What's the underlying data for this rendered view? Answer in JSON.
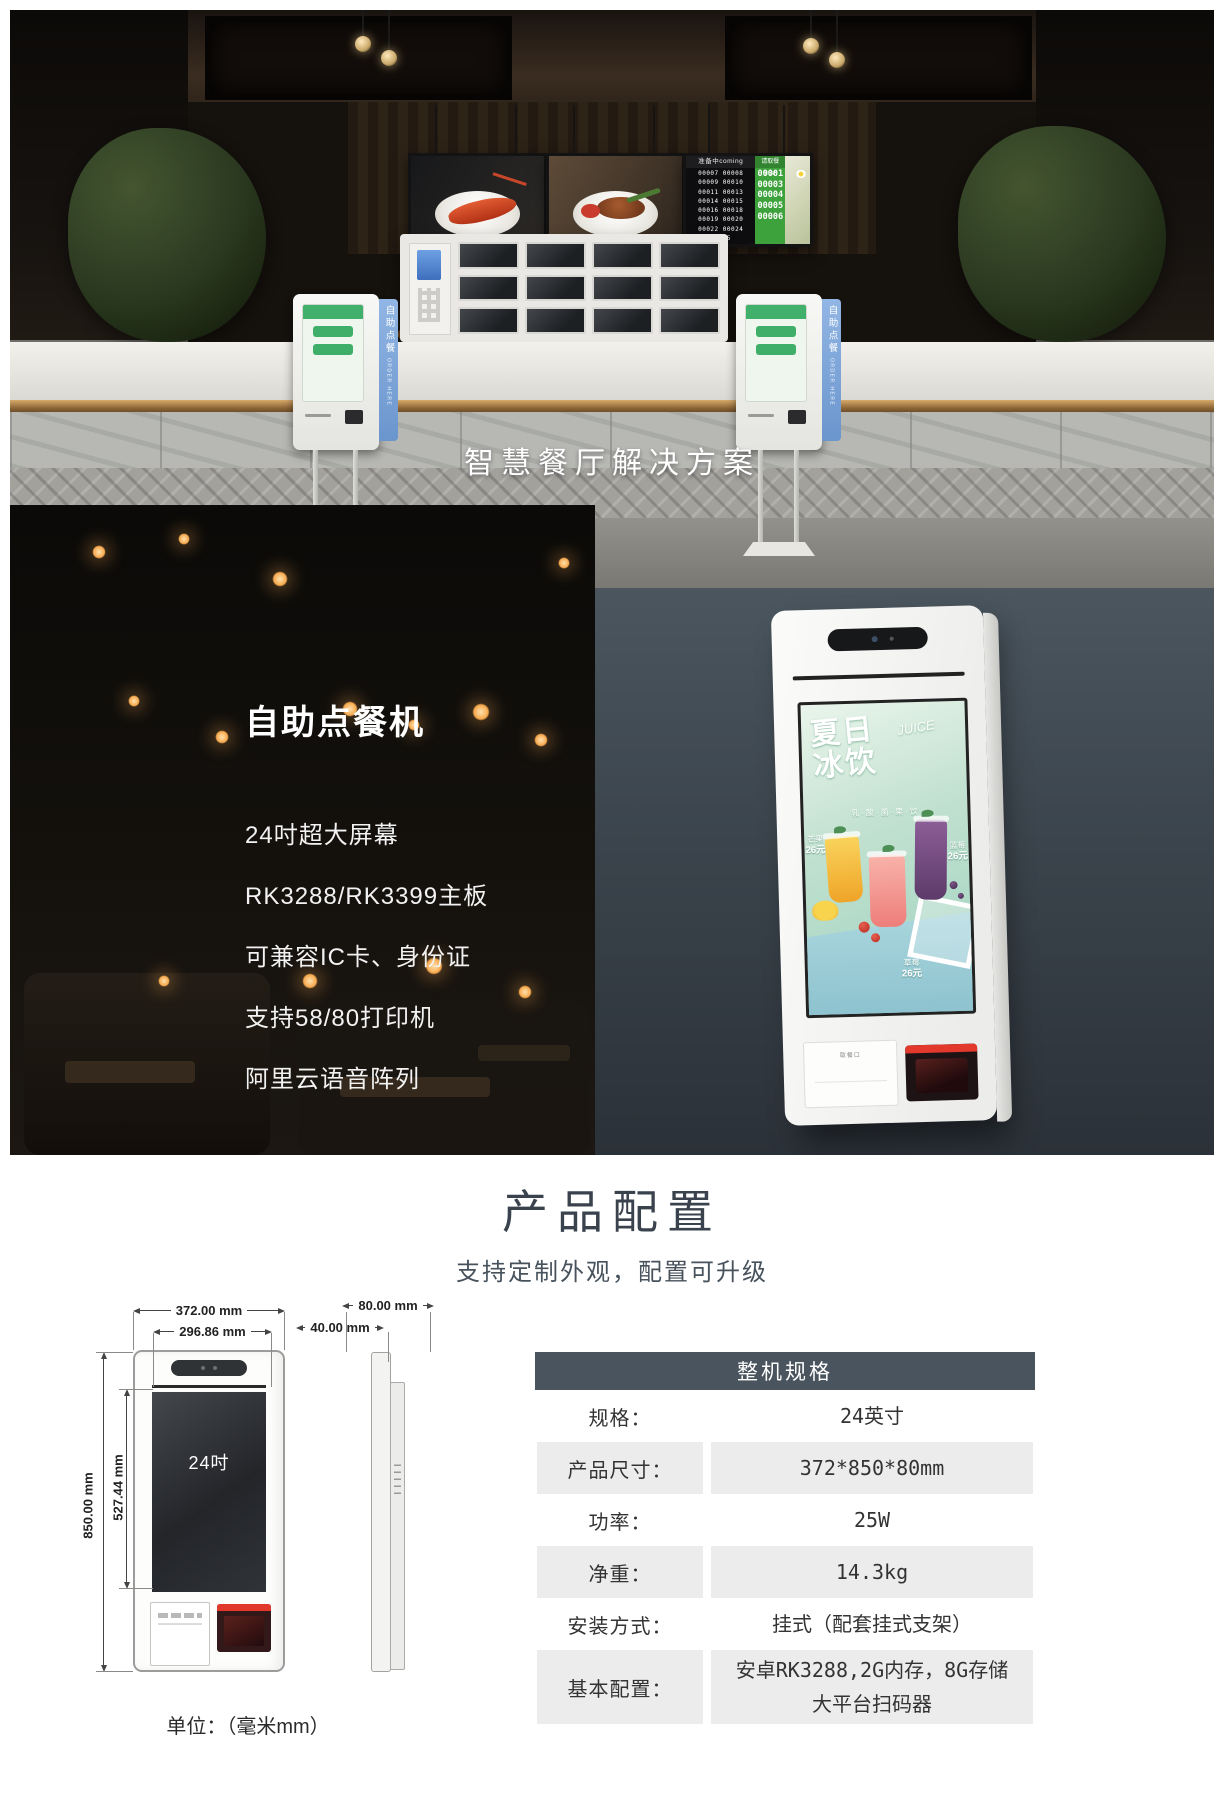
{
  "hero": {
    "title": "智慧餐厅解决方案",
    "kiosk_banner_cn": "自助点餐",
    "kiosk_banner_en": "ORDER HERE",
    "queue_board": {
      "coming_header": "准备中coming",
      "finish_header": "请取餐finish",
      "coming_lines": [
        "00007  00008",
        "00009  00010",
        "00011  00013",
        "00014  00015",
        "00016  00018",
        "00019  00020",
        "00022  00024",
        "00025"
      ],
      "finish_numbers": [
        "00001",
        "00003",
        "00004",
        "00005",
        "00006"
      ]
    }
  },
  "product": {
    "title": "自助点餐机",
    "features": [
      "24吋超大屏幕",
      "RK3288/RK3399主板",
      "可兼容IC卡、身份证",
      "支持58/80打印机",
      "阿里云语音阵列"
    ],
    "poster": {
      "title_line1": "夏日",
      "title_line2": "冰饮",
      "script": "JUICE",
      "subtitle": "乳·酸·菌·果·饮",
      "items": [
        {
          "name": "芒果",
          "price": "26元"
        },
        {
          "name": "蓝莓",
          "price": "26元"
        },
        {
          "name": "草莓",
          "price": "26元"
        }
      ]
    },
    "panel": {
      "printer_label": "取餐口",
      "scanner_label": "扫码区"
    }
  },
  "config": {
    "title": "产品配置",
    "subtitle": "支持定制外观，配置可升级",
    "drawing": {
      "width_outer": "372.00 mm",
      "width_screen": "296.86 mm",
      "depth_total": "80.00 mm",
      "depth_body": "40.00 mm",
      "height_outer": "850.00 mm",
      "height_screen": "527.44 mm",
      "screen_label": "24吋",
      "unit": "单位：（毫米mm）"
    },
    "table": {
      "header": "整机规格",
      "rows": [
        {
          "label": "规格：",
          "value": "24英寸"
        },
        {
          "label": "产品尺寸：",
          "value": "372*850*80mm"
        },
        {
          "label": "功率：",
          "value": "25W"
        },
        {
          "label": "净重：",
          "value": "14.3kg"
        },
        {
          "label": "安装方式：",
          "value": "挂式（配套挂式支架）"
        },
        {
          "label": "基本配置：",
          "value": "安卓RK3288,2G内存，8G存储",
          "value2": "大平台扫码器"
        }
      ]
    }
  },
  "colors": {
    "table_header": "#4A545E",
    "table_row_gray": "#ECECEC",
    "banner_blue": "#6A95CD",
    "slate_background": "#3B444C",
    "scanner_red": "#E2392C",
    "poster_mint": "#C2E1D0",
    "queue_green": "#3DA23B"
  }
}
